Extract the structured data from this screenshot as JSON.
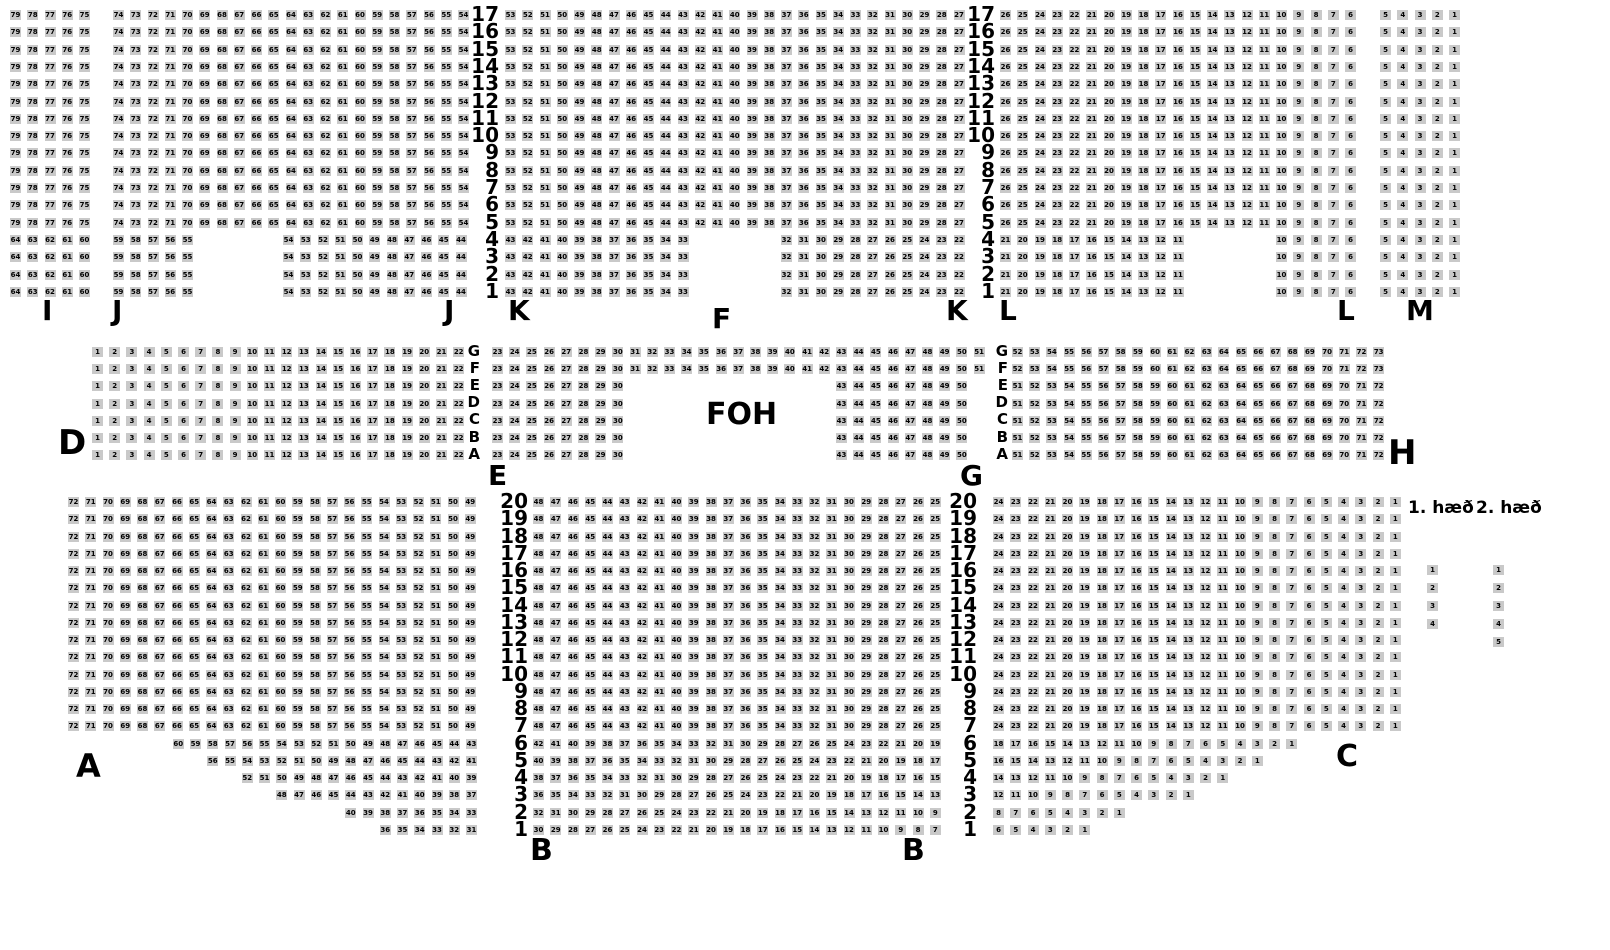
{
  "page": {
    "background_color": "#ffffff",
    "seat_color": "#c9c9c9",
    "seat_text_color": "#000000"
  },
  "foh": {
    "label": "FOH"
  },
  "legend": {
    "floor1_label": "1. hæð",
    "floor2_label": "2. hæð",
    "floor1_seats": [
      1,
      2,
      3,
      4
    ],
    "floor2_seats": [
      1,
      2,
      3,
      4,
      5
    ],
    "col1_x": 1427,
    "col2_x": 1493,
    "y0": 565,
    "pitch": 18
  },
  "section_labels": [
    {
      "name": "section-label-i",
      "text": "I",
      "x": 42,
      "y": 297,
      "size": 28
    },
    {
      "name": "section-label-j-left",
      "text": "J",
      "x": 112,
      "y": 297,
      "size": 28
    },
    {
      "name": "section-label-j-right",
      "text": "J",
      "x": 444,
      "y": 297,
      "size": 28
    },
    {
      "name": "section-label-k-left",
      "text": "K",
      "x": 508,
      "y": 297,
      "size": 28
    },
    {
      "name": "section-label-f",
      "text": "F",
      "x": 712,
      "y": 305,
      "size": 28
    },
    {
      "name": "section-label-k-right",
      "text": "K",
      "x": 946,
      "y": 297,
      "size": 28
    },
    {
      "name": "section-label-l-left",
      "text": "L",
      "x": 999,
      "y": 297,
      "size": 28
    },
    {
      "name": "section-label-l-right",
      "text": "L",
      "x": 1337,
      "y": 297,
      "size": 28
    },
    {
      "name": "section-label-m",
      "text": "M",
      "x": 1406,
      "y": 297,
      "size": 28
    },
    {
      "name": "section-label-d",
      "text": "D",
      "x": 58,
      "y": 426,
      "size": 34
    },
    {
      "name": "section-label-e",
      "text": "E",
      "x": 488,
      "y": 462,
      "size": 28
    },
    {
      "name": "section-label-g",
      "text": "G",
      "x": 960,
      "y": 462,
      "size": 28
    },
    {
      "name": "section-label-h",
      "text": "H",
      "x": 1388,
      "y": 436,
      "size": 34
    },
    {
      "name": "section-label-a",
      "text": "A",
      "x": 76,
      "y": 750,
      "size": 32
    },
    {
      "name": "section-label-b-left",
      "text": "B",
      "x": 530,
      "y": 836,
      "size": 30
    },
    {
      "name": "section-label-b-right",
      "text": "B",
      "x": 902,
      "y": 836,
      "size": 30
    },
    {
      "name": "section-label-c",
      "text": "C",
      "x": 1336,
      "y": 742,
      "size": 30
    }
  ],
  "bands": [
    {
      "name": "balcony",
      "rows": [
        "17",
        "16",
        "15",
        "14",
        "13",
        "12",
        "11",
        "10",
        "9",
        "8",
        "7",
        "6",
        "5",
        "4",
        "3",
        "2",
        "1"
      ],
      "y0": 10,
      "pitch_y": 17.3,
      "pitch_x": 17.25,
      "label_columns": [
        {
          "x_right": 499,
          "font": 20
        },
        {
          "x_right": 995,
          "font": 20
        }
      ],
      "blocks": [
        {
          "section": "I",
          "x": 10,
          "rowspan": [
            "17",
            "5"
          ],
          "from": 79,
          "to": 75
        },
        {
          "section": "I",
          "x": 10,
          "rowspan": [
            "4",
            "1"
          ],
          "from": 64,
          "to": 60
        },
        {
          "section": "J",
          "x": 113,
          "rowspan": [
            "17",
            "5"
          ],
          "from": 74,
          "to": 54
        },
        {
          "section": "J",
          "x": 113,
          "rowspan": [
            "4",
            "1"
          ],
          "from": 59,
          "to": 55
        },
        {
          "section": "J",
          "x": 283,
          "rowspan": [
            "4",
            "1"
          ],
          "from": 54,
          "to": 44
        },
        {
          "section": "K",
          "x": 505,
          "rowspan": [
            "17",
            "5"
          ],
          "from": 53,
          "to": 27
        },
        {
          "section": "K",
          "x": 505,
          "rowspan": [
            "4",
            "1"
          ],
          "from": 43,
          "to": 33
        },
        {
          "section": "K",
          "x": 781,
          "rowspan": [
            "4",
            "1"
          ],
          "from": 32,
          "to": 22
        },
        {
          "section": "L",
          "x": 1000,
          "rowspan": [
            "17",
            "5"
          ],
          "from": 26,
          "to": 6
        },
        {
          "section": "L",
          "x": 1000,
          "rowspan": [
            "4",
            "1"
          ],
          "from": 21,
          "to": 11
        },
        {
          "section": "L",
          "x": 1276,
          "rowspan": [
            "4",
            "1"
          ],
          "from": 10,
          "to": 6
        },
        {
          "section": "M",
          "x": 1380,
          "rowspan": [
            "17",
            "1"
          ],
          "from": 5,
          "to": 1
        }
      ]
    },
    {
      "name": "middle",
      "rows": [
        "G",
        "F",
        "E",
        "D",
        "C",
        "B",
        "A"
      ],
      "y0": 347,
      "pitch_y": 17.2,
      "pitch_x": 17.2,
      "label_columns": [
        {
          "x_right": 480,
          "font": 15
        },
        {
          "x_right": 1008,
          "font": 15
        }
      ],
      "blocks": [
        {
          "section": "D",
          "x": 92,
          "rowspan": [
            "G",
            "A"
          ],
          "from": 1,
          "to": 22
        },
        {
          "section": "E",
          "x": 492,
          "rowspan": [
            "G",
            "F"
          ],
          "from": 23,
          "to": 51
        },
        {
          "section": "E",
          "x": 492,
          "rowspan": [
            "E",
            "A"
          ],
          "from": 23,
          "to": 30
        },
        {
          "section": "G",
          "x": 836,
          "rowspan": [
            "E",
            "A"
          ],
          "from": 43,
          "to": 50
        },
        {
          "section": "H",
          "x": 1012,
          "rowspan": [
            "G",
            "F"
          ],
          "from": 52,
          "to": 73
        },
        {
          "section": "H",
          "x": 1012,
          "rowspan": [
            "E",
            "A"
          ],
          "from": 51,
          "to": 72
        }
      ]
    },
    {
      "name": "floor",
      "rows": [
        "20",
        "19",
        "18",
        "17",
        "16",
        "15",
        "14",
        "13",
        "12",
        "11",
        "10",
        "9",
        "8",
        "7",
        "6",
        "5",
        "4",
        "3",
        "2",
        "1"
      ],
      "y0": 497,
      "pitch_y": 17.25,
      "pitch_x": 17.25,
      "label_columns": [
        {
          "x_right": 528,
          "font": 20
        },
        {
          "x_right": 977,
          "font": 20
        }
      ],
      "blocks": [
        {
          "section": "A",
          "x": 68,
          "rowspan": [
            "20",
            "7"
          ],
          "from": 72,
          "to": 49
        },
        {
          "section": "A",
          "x": 172.75,
          "rowspan": [
            "6",
            "6"
          ],
          "from": 60,
          "to": 43
        },
        {
          "section": "A",
          "x": 207.25,
          "rowspan": [
            "5",
            "5"
          ],
          "from": 56,
          "to": 41
        },
        {
          "section": "A",
          "x": 241.75,
          "rowspan": [
            "4",
            "4"
          ],
          "from": 52,
          "to": 39
        },
        {
          "section": "A",
          "x": 276.25,
          "rowspan": [
            "3",
            "3"
          ],
          "from": 48,
          "to": 37
        },
        {
          "section": "A",
          "x": 345.25,
          "rowspan": [
            "2",
            "2"
          ],
          "from": 40,
          "to": 33
        },
        {
          "section": "A",
          "x": 379.75,
          "rowspan": [
            "1",
            "1"
          ],
          "from": 36,
          "to": 31
        },
        {
          "section": "B",
          "x": 533,
          "rowspan": [
            "20",
            "7"
          ],
          "from": 48,
          "to": 25
        },
        {
          "section": "B",
          "x": 533,
          "rowspan": [
            "6",
            "6"
          ],
          "from": 42,
          "to": 19
        },
        {
          "section": "B",
          "x": 533,
          "rowspan": [
            "5",
            "5"
          ],
          "from": 40,
          "to": 17
        },
        {
          "section": "B",
          "x": 533,
          "rowspan": [
            "4",
            "4"
          ],
          "from": 38,
          "to": 15
        },
        {
          "section": "B",
          "x": 533,
          "rowspan": [
            "3",
            "3"
          ],
          "from": 36,
          "to": 13
        },
        {
          "section": "B",
          "x": 533,
          "rowspan": [
            "2",
            "2"
          ],
          "from": 32,
          "to": 9
        },
        {
          "section": "B",
          "x": 533,
          "rowspan": [
            "1",
            "1"
          ],
          "from": 30,
          "to": 7
        },
        {
          "section": "C",
          "x": 993,
          "rowspan": [
            "20",
            "7"
          ],
          "from": 24,
          "to": 1
        },
        {
          "section": "C",
          "x": 993,
          "rowspan": [
            "6",
            "6"
          ],
          "from": 18,
          "to": 1
        },
        {
          "section": "C",
          "x": 993,
          "rowspan": [
            "5",
            "5"
          ],
          "from": 16,
          "to": 1
        },
        {
          "section": "C",
          "x": 993,
          "rowspan": [
            "4",
            "4"
          ],
          "from": 14,
          "to": 1
        },
        {
          "section": "C",
          "x": 993,
          "rowspan": [
            "3",
            "3"
          ],
          "from": 12,
          "to": 1
        },
        {
          "section": "C",
          "x": 993,
          "rowspan": [
            "2",
            "2"
          ],
          "from": 8,
          "to": 1
        },
        {
          "section": "C",
          "x": 993,
          "rowspan": [
            "1",
            "1"
          ],
          "from": 6,
          "to": 1
        }
      ]
    }
  ]
}
